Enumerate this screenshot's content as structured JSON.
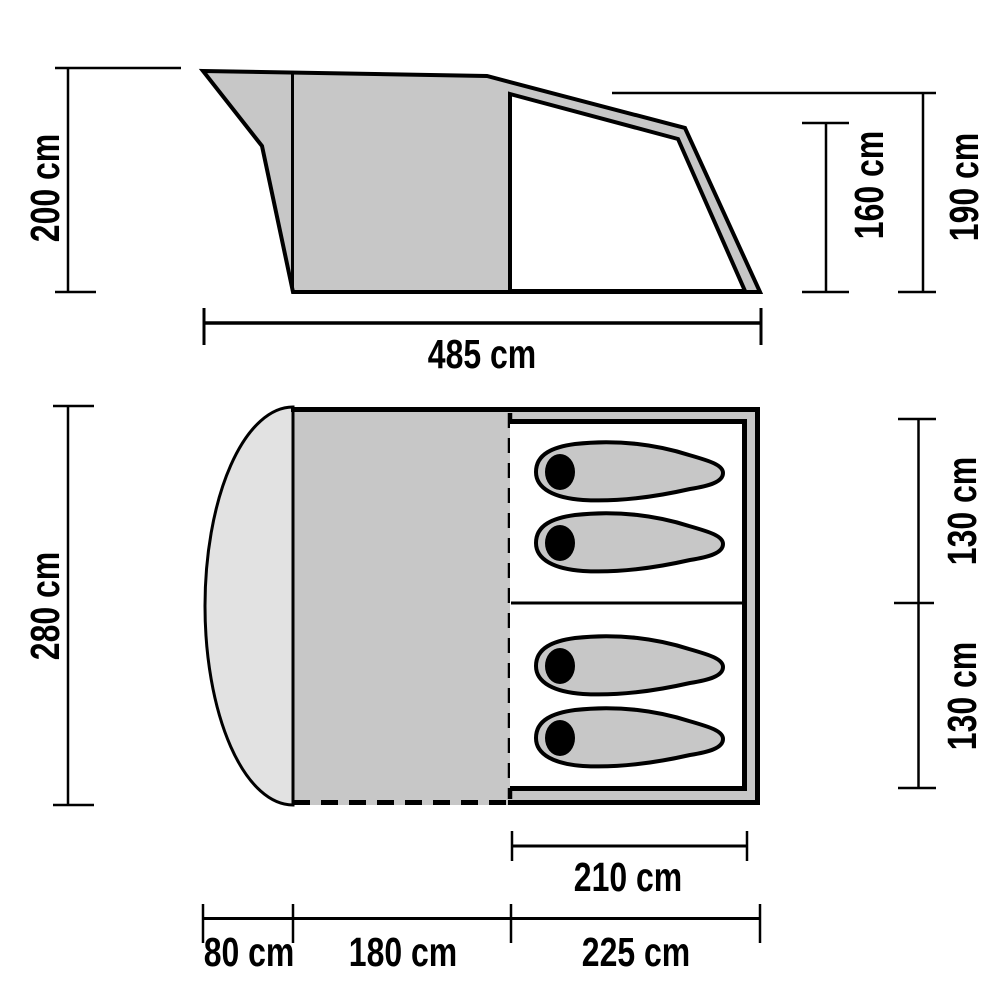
{
  "diagram": {
    "kind": "tent-dimension-diagram",
    "views": [
      "side-elevation",
      "floor-plan"
    ]
  },
  "colors": {
    "tent_gray": "#c7c7c7",
    "porch_gray": "#e2e2e2",
    "cabin_white": "#ffffff",
    "outline_black": "#000000",
    "background": "#ffffff"
  },
  "side_view": {
    "labels": {
      "total_height": "200 cm",
      "total_length": "485 cm",
      "rear_height": "160 cm",
      "inner_height": "190 cm"
    }
  },
  "floor_plan": {
    "labels": {
      "total_width": "280 cm",
      "inner_cabin_length": "210 cm",
      "porch_depth": "80 cm",
      "living_room_depth": "180 cm",
      "sleeping_cabin_depth": "225 cm",
      "berth_width_top": "130 cm",
      "berth_width_bottom": "130 cm"
    },
    "sleeping_bags": 4
  }
}
